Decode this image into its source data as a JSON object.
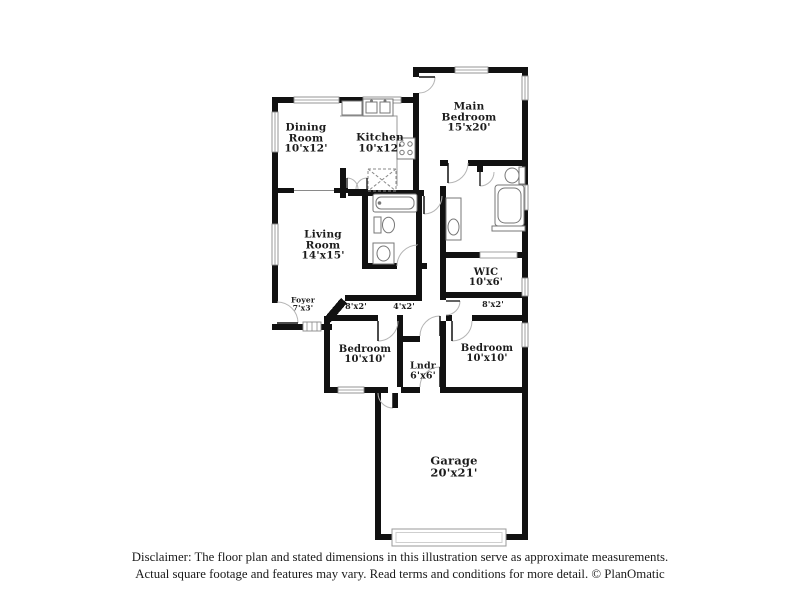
{
  "floor_plan": {
    "rooms": {
      "dining": {
        "name1": "Dining",
        "name2": "Room",
        "dims": "10'x12'"
      },
      "kitchen": {
        "name1": "Kitchen",
        "dims": "10'x12'"
      },
      "main_bedroom": {
        "name1": "Main",
        "name2": "Bedroom",
        "dims": "15'x20'"
      },
      "living": {
        "name1": "Living",
        "name2": "Room",
        "dims": "14'x15'"
      },
      "foyer": {
        "name1": "Foyer",
        "dims": "7'x3'"
      },
      "hall_left": {
        "dims": "8'x2'"
      },
      "hall_center": {
        "dims": "4'x2'"
      },
      "hall_right": {
        "dims": "8'x2'"
      },
      "wic": {
        "name1": "WIC",
        "dims": "10'x6'"
      },
      "bedroom_left": {
        "name1": "Bedroom",
        "dims": "10'x10'"
      },
      "laundry": {
        "name1": "Lndr",
        "dims": "6'x6'"
      },
      "bedroom_right": {
        "name1": "Bedroom",
        "dims": "10'x10'"
      },
      "garage": {
        "name1": "Garage",
        "dims": "20'x21'"
      }
    },
    "disclaimer_line1": "Disclaimer: The floor plan and stated dimensions in this illustration serve as approximate measurements.",
    "disclaimer_line2": "Actual square footage and features may vary. Read terms and conditions for more detail. © PlanOmatic",
    "colors": {
      "wall": "#111111",
      "window_outline": "#8a8a8a",
      "fixture_outline": "#777777",
      "door_arc": "#b5b5b5",
      "text": "#1c1c1c"
    }
  }
}
